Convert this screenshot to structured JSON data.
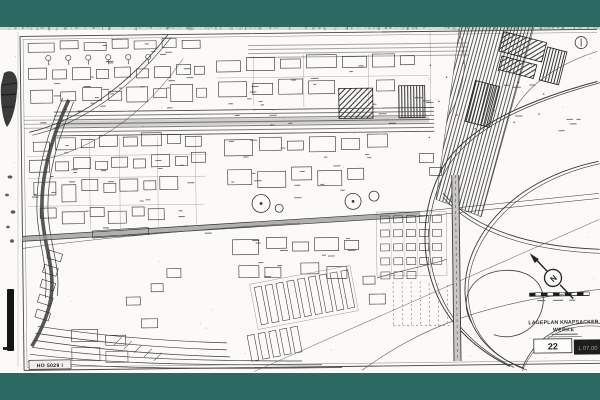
{
  "meta": {
    "content_type": "scanned industrial site plan drawing"
  },
  "colors": {
    "letterbox_teal": "#2d6963",
    "paper": "#fbfaf7",
    "ink": "#2f2f2f"
  },
  "title_block": {
    "line1": "LAGEPLAN  KNAPSACKER",
    "line2": "WERKE",
    "sheet_number": "22",
    "plate_code": "L 07.00"
  },
  "compass": {
    "label": "N"
  },
  "stamp": {
    "text": "HO 5029 i"
  }
}
